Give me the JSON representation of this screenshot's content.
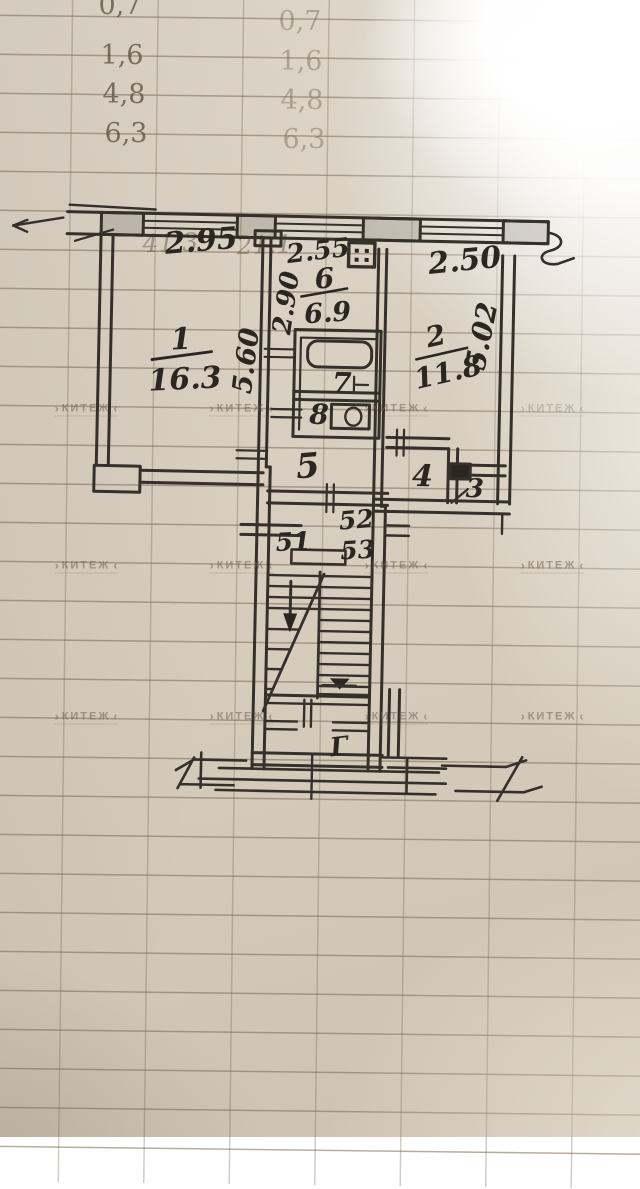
{
  "meta": {
    "description": "Photograph of a hand-drawn two-room apartment floor plan sketched in ink on ledger grid paper"
  },
  "ledger": {
    "left_column": [
      "0,7",
      "1,6",
      "4,8",
      "6,3"
    ],
    "right_column": [
      "0,7",
      "1,6",
      "4,8",
      "6,3"
    ]
  },
  "faint_print": {
    "total": "41.3",
    "partial": "21.1"
  },
  "plan": {
    "rooms": [
      {
        "number": "1",
        "area": "16.3"
      },
      {
        "number": "6",
        "area": "6.9"
      },
      {
        "number": "2",
        "area": "11.8"
      },
      {
        "number": "5",
        "area": ""
      },
      {
        "number": "7",
        "area": ""
      },
      {
        "number": "8",
        "area": ""
      },
      {
        "number": "4",
        "area": ""
      },
      {
        "number": "3",
        "area": ""
      }
    ],
    "dimensions": {
      "room1_width": "2.95",
      "kitchen_width": "2.55",
      "room2_width": "2.50",
      "kitchen_depth": "2.90",
      "room1_depth": "5.60",
      "room2_depth": "5.02"
    },
    "apartments": [
      "51",
      "52",
      "53"
    ],
    "entrance_mark": "Г"
  },
  "watermark": {
    "text": "КИТЕЖ"
  },
  "colors": {
    "paper": "#d7cebf",
    "ink": "#2b2620",
    "grid_line": "#7b6a55",
    "watermark": "#6f6354"
  }
}
